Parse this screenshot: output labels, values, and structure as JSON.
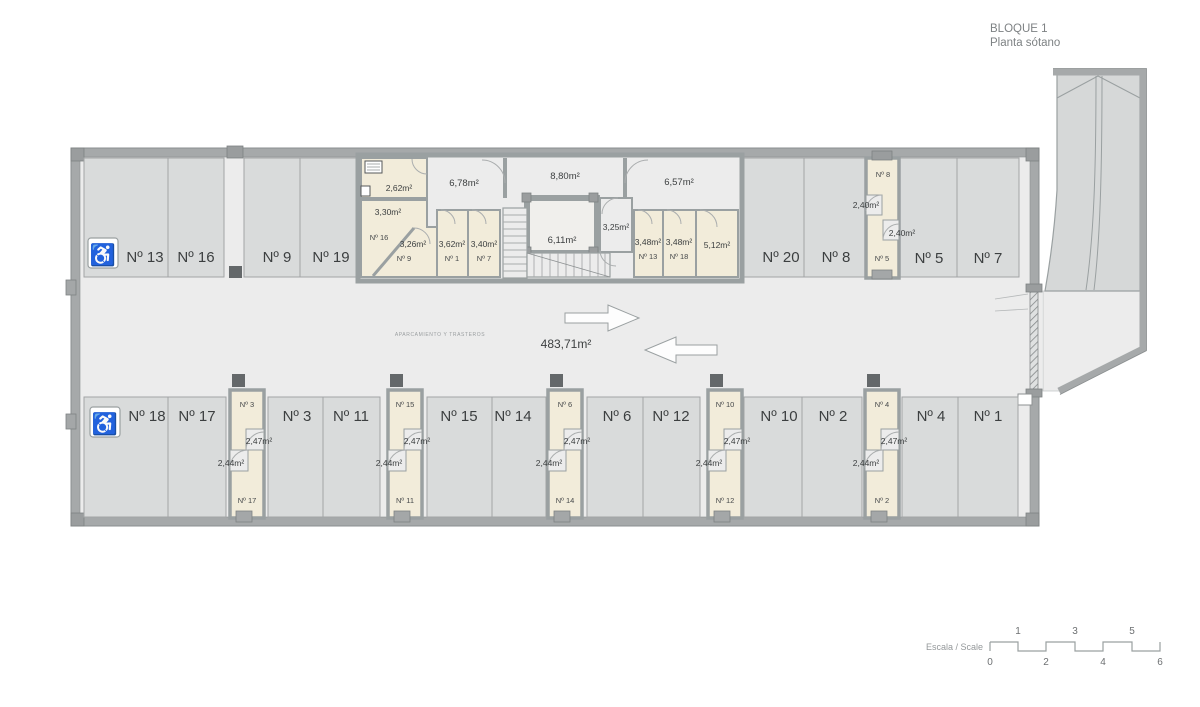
{
  "header": {
    "title": "BLOQUE 1",
    "subtitle": "Planta sótano"
  },
  "plan": {
    "zone_label": "APARCAMIENTO Y TRASTEROS",
    "total_area": "483,71m²"
  },
  "parking_top": [
    {
      "label": "Nº 13",
      "handicap": true
    },
    {
      "label": "Nº 16"
    },
    {
      "label": "Nº 9"
    },
    {
      "label": "Nº 19"
    },
    {
      "label": "Nº 20"
    },
    {
      "label": "Nº 8"
    },
    {
      "label": "Nº 5"
    },
    {
      "label": "Nº 7"
    }
  ],
  "parking_bottom": [
    {
      "label": "Nº 18",
      "handicap": true
    },
    {
      "label": "Nº 17"
    },
    {
      "label": "Nº 3"
    },
    {
      "label": "Nº 11"
    },
    {
      "label": "Nº 15"
    },
    {
      "label": "Nº 14"
    },
    {
      "label": "Nº 6"
    },
    {
      "label": "Nº 12"
    },
    {
      "label": "Nº 10"
    },
    {
      "label": "Nº 2"
    },
    {
      "label": "Nº 4"
    },
    {
      "label": "Nº 1"
    }
  ],
  "storage_top": {
    "utility_area": "2,62m²",
    "room16": {
      "area": "3,30m²",
      "label": "Nº 16"
    },
    "room9": {
      "area": "3,26m²",
      "label": "Nº 9"
    },
    "room1": {
      "area": "3,62m²",
      "label": "Nº 1"
    },
    "room7": {
      "area": "3,40m²",
      "label": "Nº 7"
    },
    "corridor_left": "6,78m²",
    "lobby": "8,80m²",
    "corridor_right": "6,57m²",
    "elevator": "6,11m²",
    "vestibule": "3,25m²",
    "room13": {
      "area": "3,48m²",
      "label": "Nº 13"
    },
    "room18": {
      "area": "3,48m²",
      "label": "Nº 18"
    },
    "room_large_area": "5,12m²",
    "col_right": {
      "top": {
        "label": "Nº 8",
        "area": "2,40m²"
      },
      "bottom": {
        "label": "Nº 5",
        "area": "2,40m²"
      }
    }
  },
  "storage_cols": [
    {
      "top_label": "Nº 3",
      "top_area": "2,47m²",
      "bottom_label": "Nº 17",
      "bottom_area": "2,44m²"
    },
    {
      "top_label": "Nº 15",
      "top_area": "2,47m²",
      "bottom_label": "Nº 11",
      "bottom_area": "2,44m²"
    },
    {
      "top_label": "Nº 6",
      "top_area": "2,47m²",
      "bottom_label": "Nº 14",
      "bottom_area": "2,44m²"
    },
    {
      "top_label": "Nº 10",
      "top_area": "2,47m²",
      "bottom_label": "Nº 12",
      "bottom_area": "2,44m²"
    },
    {
      "top_label": "Nº 4",
      "top_area": "2,47m²",
      "bottom_label": "Nº 2",
      "bottom_area": "2,44m²"
    }
  ],
  "icons": {
    "accessible": "♿"
  },
  "scale_bar": {
    "label": "Escala / Scale",
    "top_ticks": [
      "1",
      "3",
      "5"
    ],
    "bottom_ticks": [
      "0",
      "2",
      "4",
      "6"
    ]
  },
  "colors": {
    "wall": "#a6a9aa",
    "floor": "#ececec",
    "stall": "#d9dbdb",
    "storage": "#f2ecda",
    "ramp": "#d6d8d8",
    "pillar": "#64686a",
    "text": "#3c3f40"
  }
}
